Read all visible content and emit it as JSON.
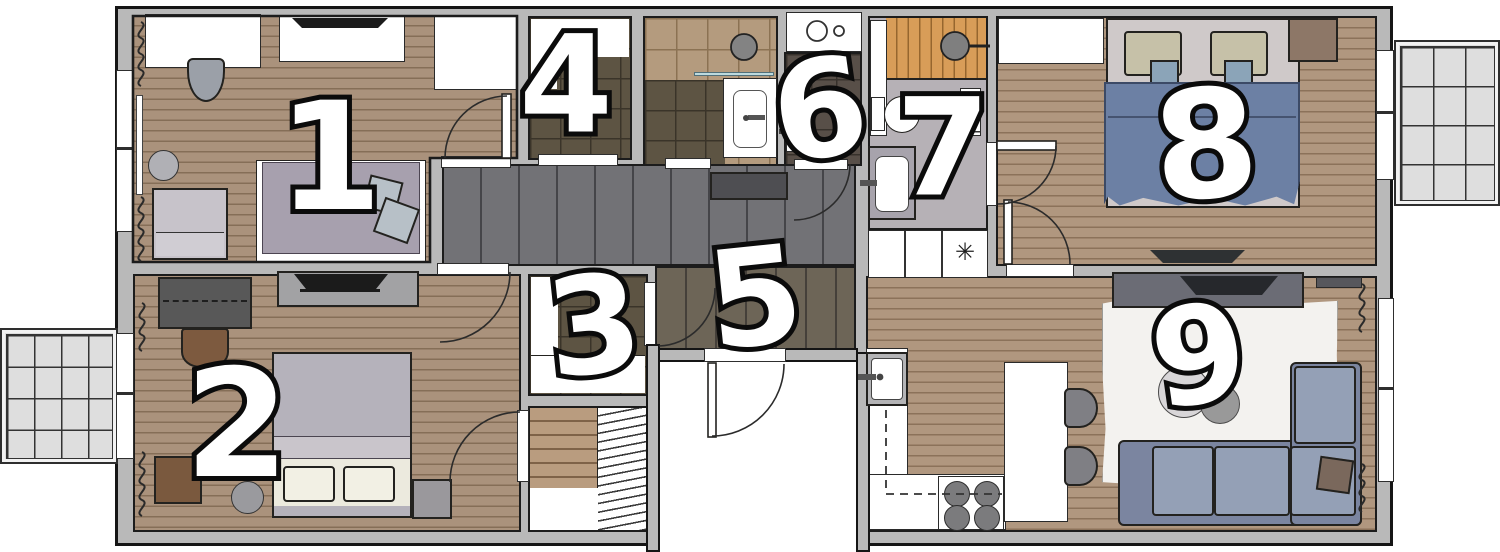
{
  "floorplan": {
    "rooms": [
      {
        "id": "room-1",
        "number": "1"
      },
      {
        "id": "room-2",
        "number": "2"
      },
      {
        "id": "room-3",
        "number": "3"
      },
      {
        "id": "room-4",
        "number": "4"
      },
      {
        "id": "room-5",
        "number": "5"
      },
      {
        "id": "room-6",
        "number": "6"
      },
      {
        "id": "room-7",
        "number": "7"
      },
      {
        "id": "room-8",
        "number": "8"
      },
      {
        "id": "room-9",
        "number": "9"
      }
    ],
    "symbols": {
      "freezer": "✳"
    },
    "colors": {
      "wall": "#b9b9b9",
      "wood": "#aa927c",
      "hall_gray": "#6f6f72",
      "hall_olive": "#6a6256",
      "tile_light": "#b49b7e",
      "tile_dark": "#5d5443",
      "tile_wc": "#584f48",
      "sauna_wood": "#d89d58",
      "duvet_blue": "#6c80a4",
      "sofa_blue": "#94a0b6",
      "bed_purple": "#a7a0ae",
      "balcony": "#dedede"
    }
  }
}
